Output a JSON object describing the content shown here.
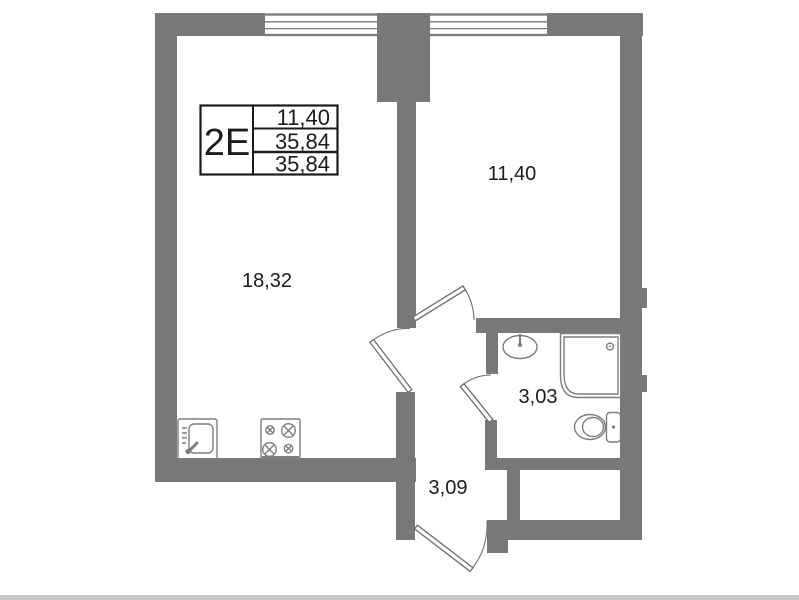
{
  "title_block": {
    "unit_type": "2E",
    "rows": [
      "11,40",
      "35,84",
      "35,84"
    ]
  },
  "rooms": {
    "living_kitchen": {
      "label": "18,32"
    },
    "bedroom": {
      "label": "11,40"
    },
    "bathroom": {
      "label": "3,03"
    },
    "hallway": {
      "label": "3,09"
    }
  },
  "fixtures": [
    "kitchen-sink-icon",
    "cooktop-icon",
    "washbasin-icon",
    "shower-cabin-icon",
    "toilet-icon",
    "window-icon",
    "door-swing-icon"
  ],
  "colors": {
    "wall": "#787878",
    "outline": "#7e7e7e",
    "door": "#6e6e6e",
    "text": "#1c1c1c",
    "background": "#ffffff",
    "page_edge": "#c9c9c9"
  }
}
